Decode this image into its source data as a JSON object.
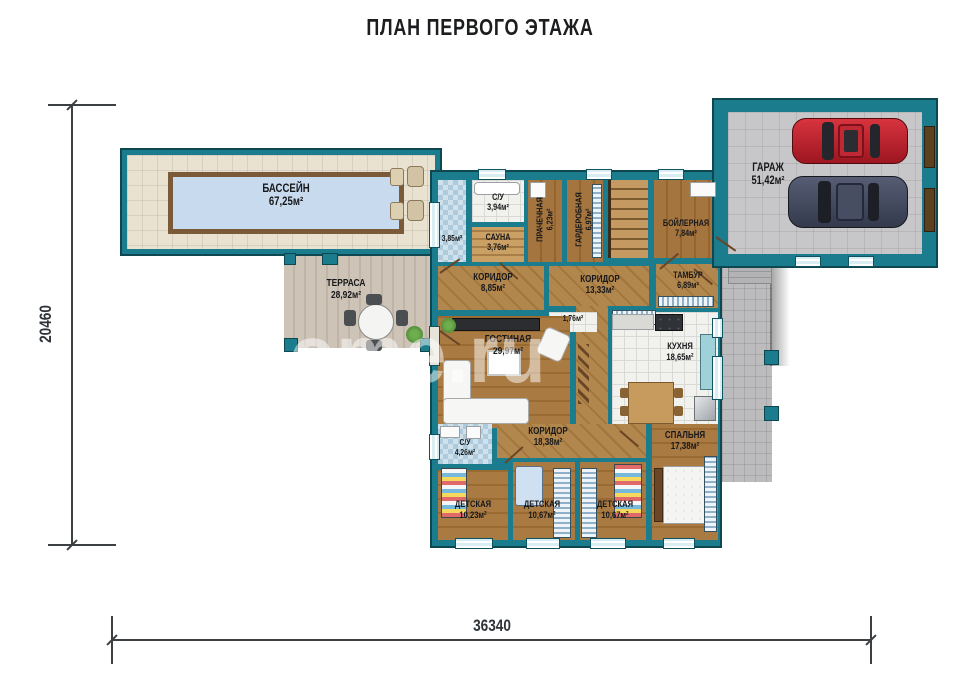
{
  "title": "ПЛАН ПЕРВОГО ЭТАЖА",
  "watermark": "northome.ru",
  "dimensions": {
    "height_label": "20460",
    "width_label": "36340"
  },
  "rooms": {
    "pool": {
      "name": "БАССЕЙН",
      "area": "67,25м²"
    },
    "terrace": {
      "name": "ТЕРРАСА",
      "area": "28,92м²"
    },
    "shower": {
      "area": "3,85м²"
    },
    "wc_top": {
      "name": "С/У",
      "area": "3,94м²"
    },
    "sauna": {
      "name": "САУНА",
      "area": "3,76м²"
    },
    "laundry": {
      "name": "ПРАЧЕЧНАЯ",
      "area": "6,23м²"
    },
    "wardrobe": {
      "name": "ГАРДЕРОБНАЯ",
      "area": "6,97м²"
    },
    "boiler": {
      "name": "БОЙЛЕРНАЯ",
      "area": "7,84м²"
    },
    "garage": {
      "name": "ГАРАЖ",
      "area": "51,42м²"
    },
    "corridor1": {
      "name": "КОРИДОР",
      "area": "8,85м²"
    },
    "corridor2": {
      "name": "КОРИДОР",
      "area": "13,33м²"
    },
    "tambour": {
      "name": "ТАМБУР",
      "area": "6,89м²"
    },
    "living": {
      "name": "ГОСТИНАЯ",
      "area": "29,97м²"
    },
    "closet": {
      "area": "1,76м²"
    },
    "kitchen": {
      "name": "КУХНЯ",
      "area": "18,65м²"
    },
    "wc_bottom": {
      "name": "С/У",
      "area": "4,26м²"
    },
    "corridor3": {
      "name": "КОРИДОР",
      "area": "18,38м²"
    },
    "bedroom": {
      "name": "СПАЛЬНЯ",
      "area": "17,38м²"
    },
    "kids1": {
      "name": "ДЕТСКАЯ",
      "area": "10,23м²"
    },
    "kids2": {
      "name": "ДЕТСКАЯ",
      "area": "10,67м²"
    },
    "kids3": {
      "name": "ДЕТСКАЯ",
      "area": "10,67м²"
    }
  },
  "colors": {
    "wall": "#1a7c8c",
    "wall_outline": "#0e4750",
    "pool_water": "#c8daee",
    "pool_border": "#7a5a38",
    "car_red": "#c0242e",
    "car_blue": "#474e63",
    "wood_floor": "#a5753f",
    "dimension": "#3c4043"
  }
}
